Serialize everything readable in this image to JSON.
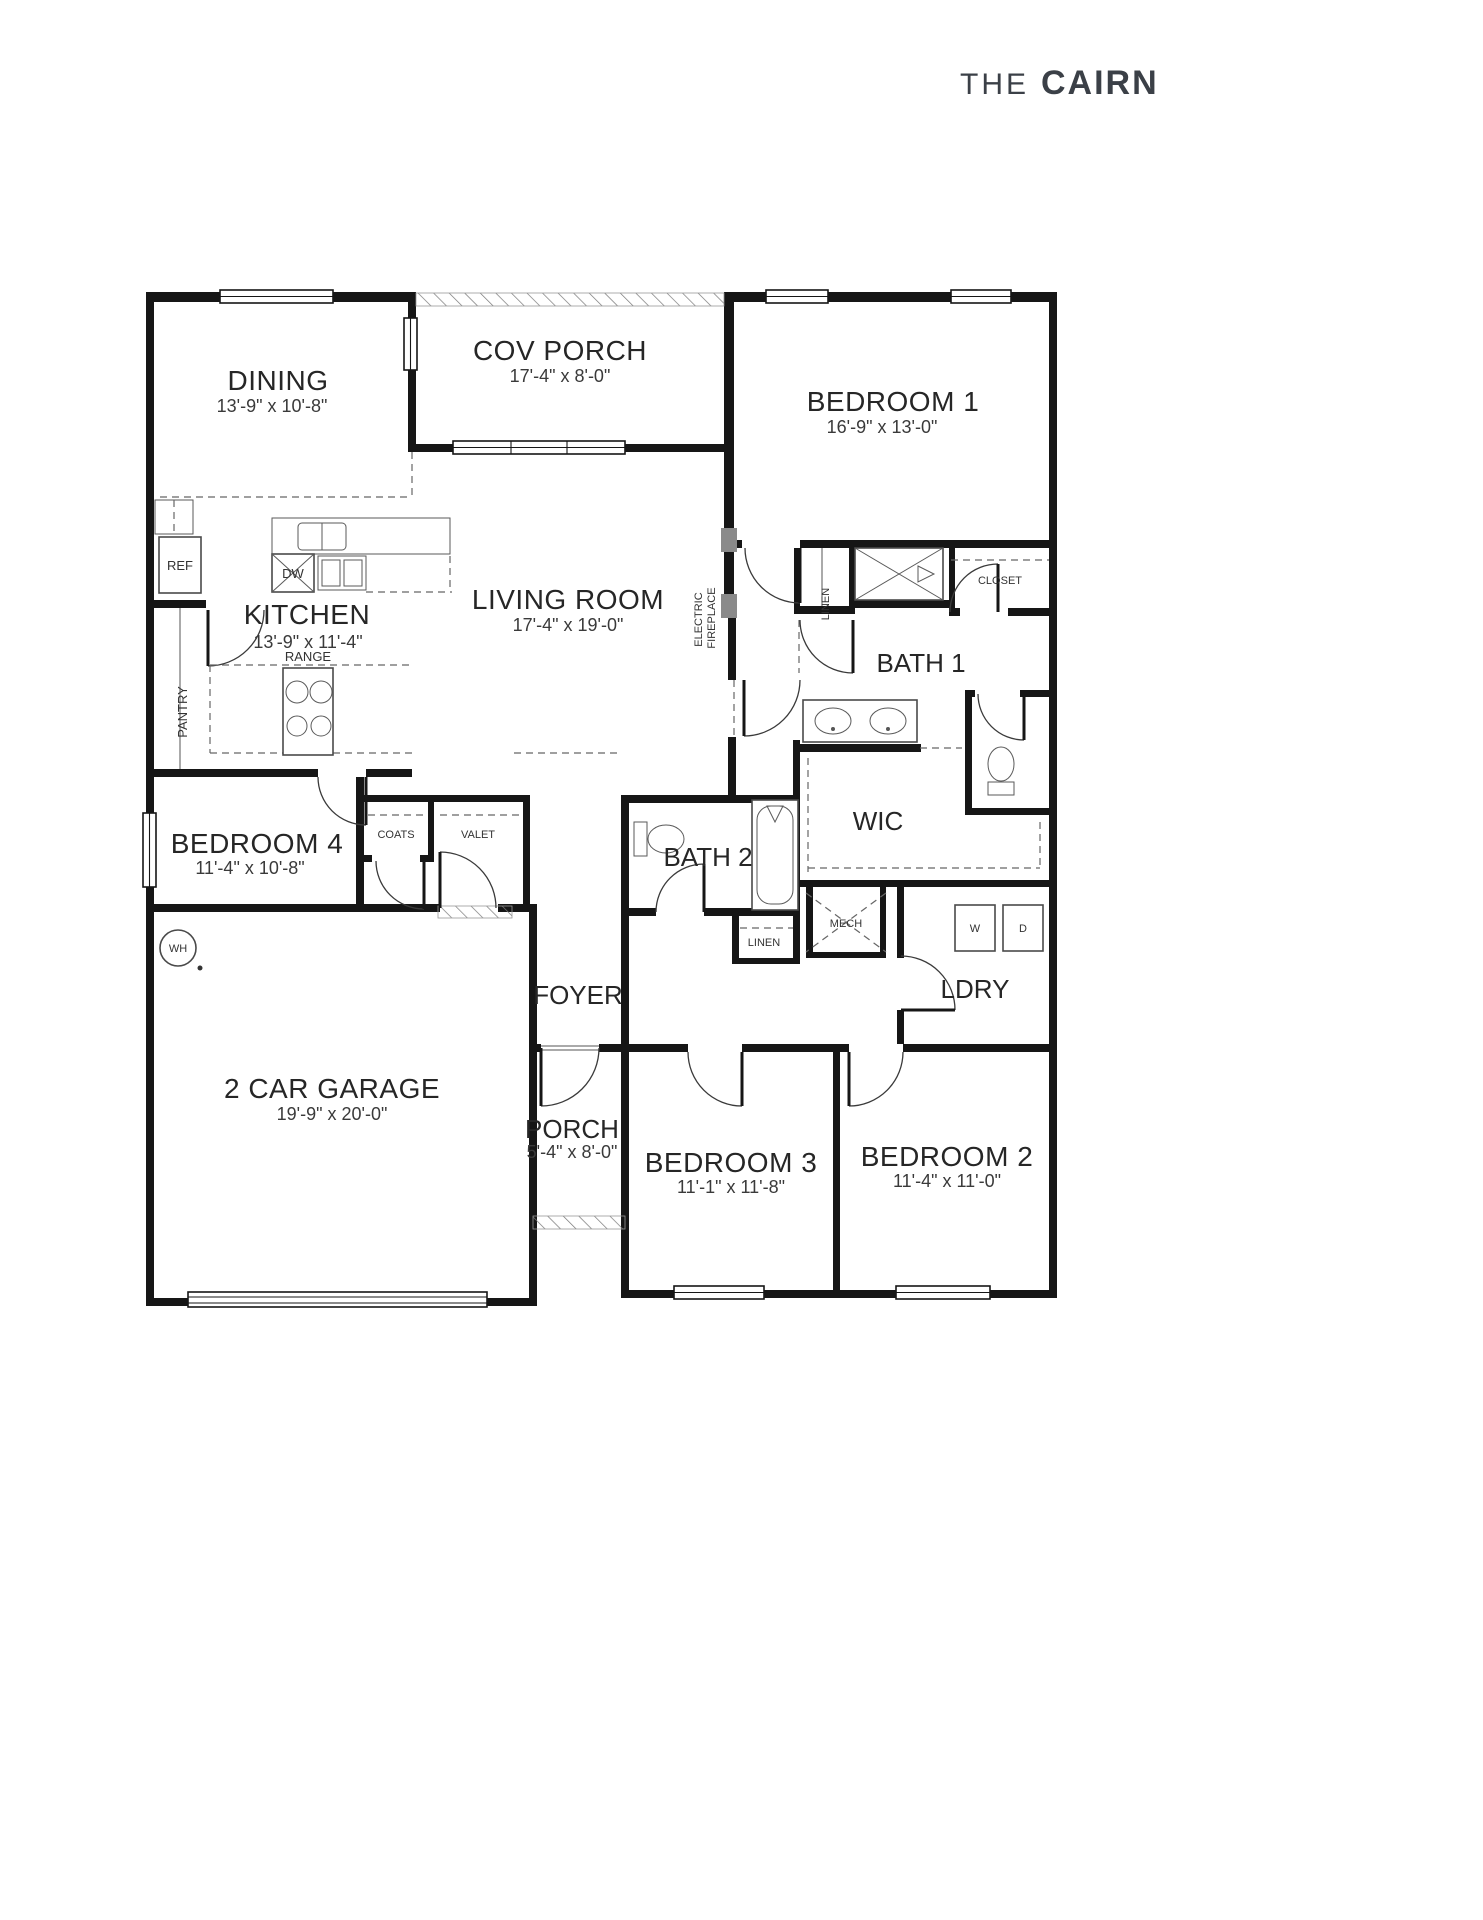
{
  "title": {
    "prefix": "THE",
    "name": "CAIRN"
  },
  "colors": {
    "wall": "#161616",
    "label": "#262626",
    "fireplace_mark": "#8a8a8a",
    "hatch": "#777777"
  },
  "rooms": {
    "dining": {
      "label": "DINING",
      "dims": "13'-9\" x 10'-8\""
    },
    "cov_porch": {
      "label": "COV PORCH",
      "dims": "17'-4\" x 8'-0\""
    },
    "bedroom1": {
      "label": "BEDROOM 1",
      "dims": "16'-9\" x 13'-0\""
    },
    "kitchen": {
      "label": "KITCHEN",
      "dims": "13'-9\" x 11'-4\""
    },
    "living": {
      "label": "LIVING ROOM",
      "dims": "17'-4\" x 19'-0\""
    },
    "bath1": {
      "label": "BATH 1"
    },
    "wic": {
      "label": "WIC"
    },
    "bedroom4": {
      "label": "BEDROOM 4",
      "dims": "11'-4\" x 10'-8\""
    },
    "bath2": {
      "label": "BATH 2"
    },
    "ldry": {
      "label": "LDRY"
    },
    "foyer": {
      "label": "FOYER"
    },
    "garage": {
      "label": "2 CAR GARAGE",
      "dims": "19'-9\" x 20'-0\""
    },
    "porch": {
      "label": "PORCH",
      "dims": "5'-4\" x 8'-0\""
    },
    "bedroom3": {
      "label": "BEDROOM 3",
      "dims": "11'-1\" x 11'-8\""
    },
    "bedroom2": {
      "label": "BEDROOM 2",
      "dims": "11'-4\" x 11'-0\""
    }
  },
  "fixtures": {
    "ref": "REF",
    "dw": "DW",
    "range": "RANGE",
    "pantry": "PANTRY",
    "linen_bath1": "LINEN",
    "closet_bed1": "CLOSET",
    "coats": "COATS",
    "valet": "VALET",
    "wh": "WH",
    "linen_hall": "LINEN",
    "mech": "MECH",
    "washer": "W",
    "dryer": "D",
    "fireplace": {
      "line1": "ELECTRIC",
      "line2": "FIREPLACE"
    }
  }
}
